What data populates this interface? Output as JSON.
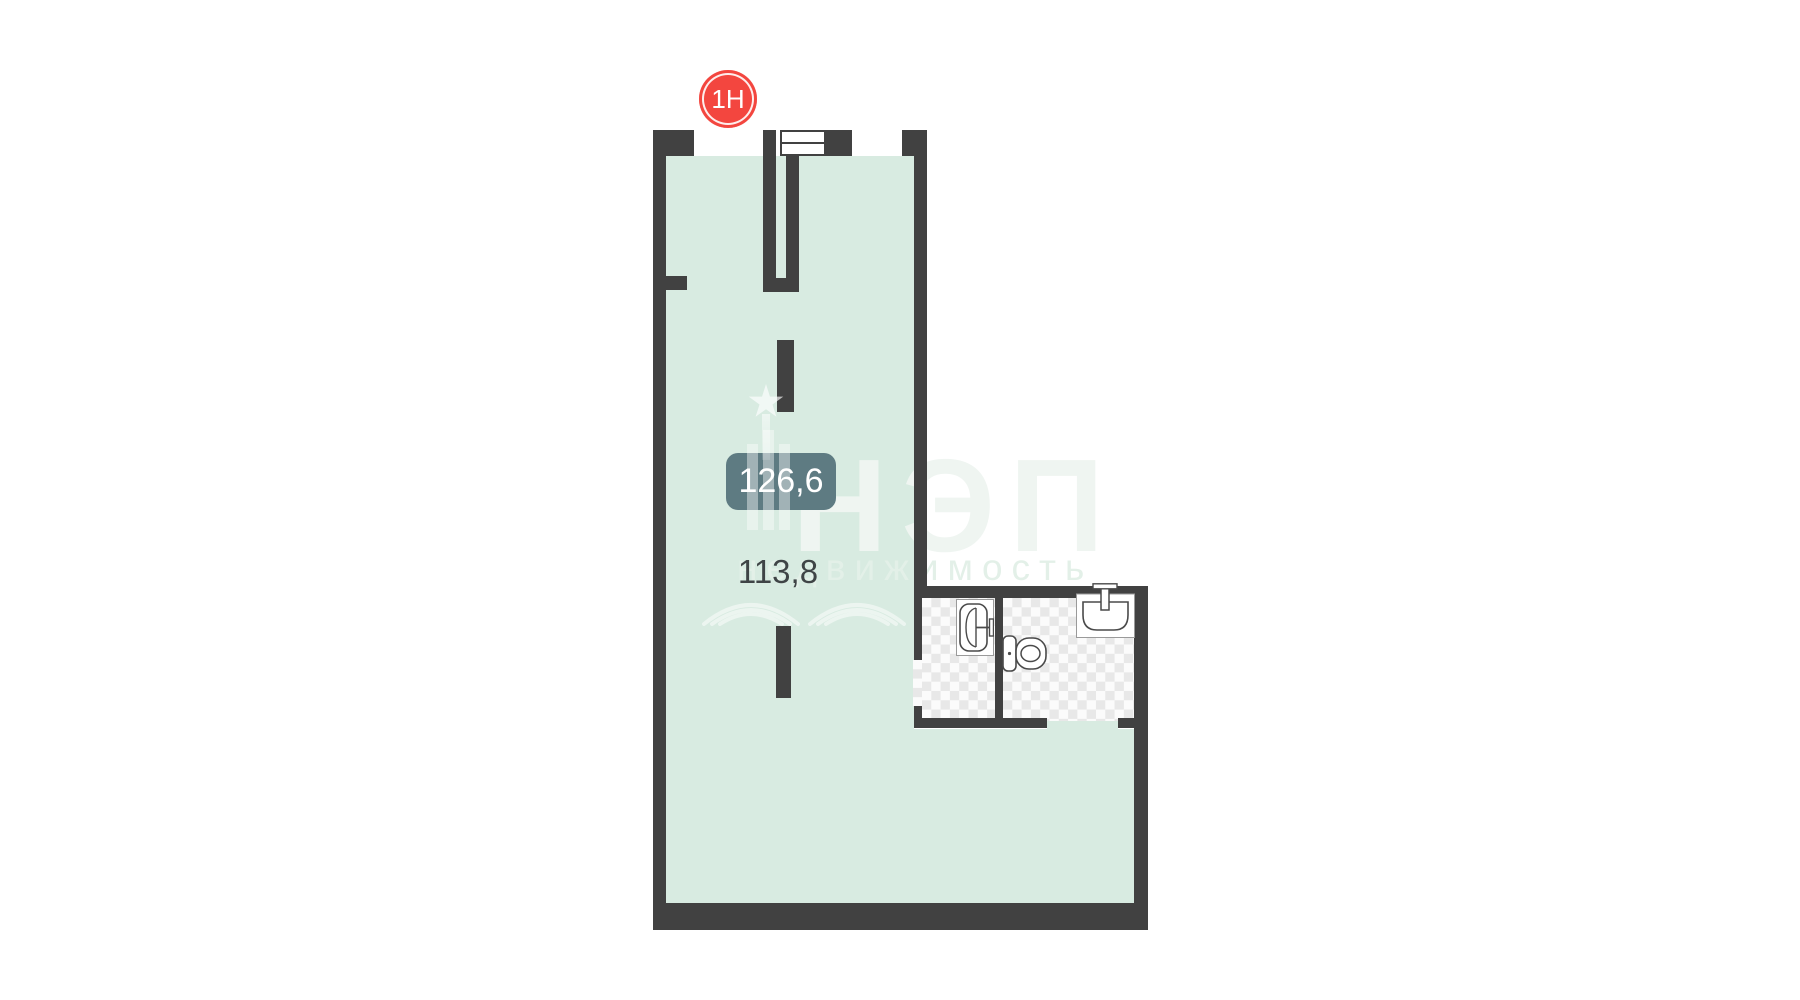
{
  "floor_plan": {
    "unit_badge": {
      "label": "1Н",
      "color": "#f3463f"
    },
    "area_badge": {
      "value": "126,6",
      "bg_color": "#5e7b82",
      "text_color": "#ffffff"
    },
    "secondary_area": {
      "value": "113,8",
      "text_color": "#3f4446"
    },
    "watermark": {
      "title": "НЭП",
      "subtitle": "недвижимость"
    },
    "colors": {
      "room_fill": "#d8ebe1",
      "wall": "#414141",
      "checker_dark": "#e8e8e8",
      "checker_light": "#fbfbfb",
      "background": "#ffffff"
    },
    "fixtures": [
      "bathtub-icon",
      "toilet-icon",
      "sink-icon",
      "window-symbol"
    ]
  }
}
